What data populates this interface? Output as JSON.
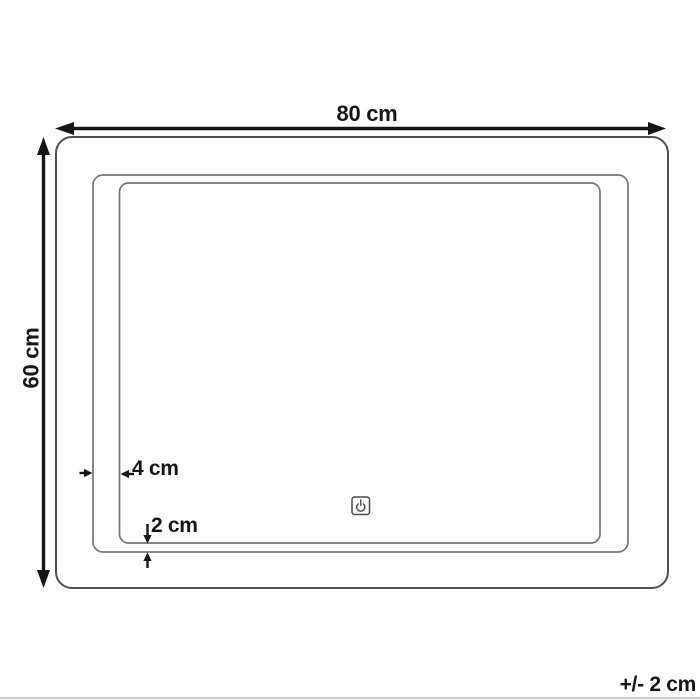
{
  "diagram": {
    "kind": "mirror-dimension-diagram",
    "icons": {
      "power_button": "power-icon"
    },
    "colors": {
      "arrow_and_text": "#161616",
      "outer_frame_stroke": "#4f4f4f",
      "inner_frame_stroke": "#757575",
      "power_icon_stroke": "#4a4a4a",
      "bottom_rule": "#c8c8c8",
      "background": "#ffffff"
    }
  },
  "dimensions": {
    "width": {
      "label": "80 cm"
    },
    "height": {
      "label": "60 cm"
    },
    "frame_offset": {
      "label": "4 cm"
    },
    "edge_offset": {
      "label": "2 cm"
    }
  },
  "footer": {
    "tolerance_label": "+/- 2 cm"
  }
}
